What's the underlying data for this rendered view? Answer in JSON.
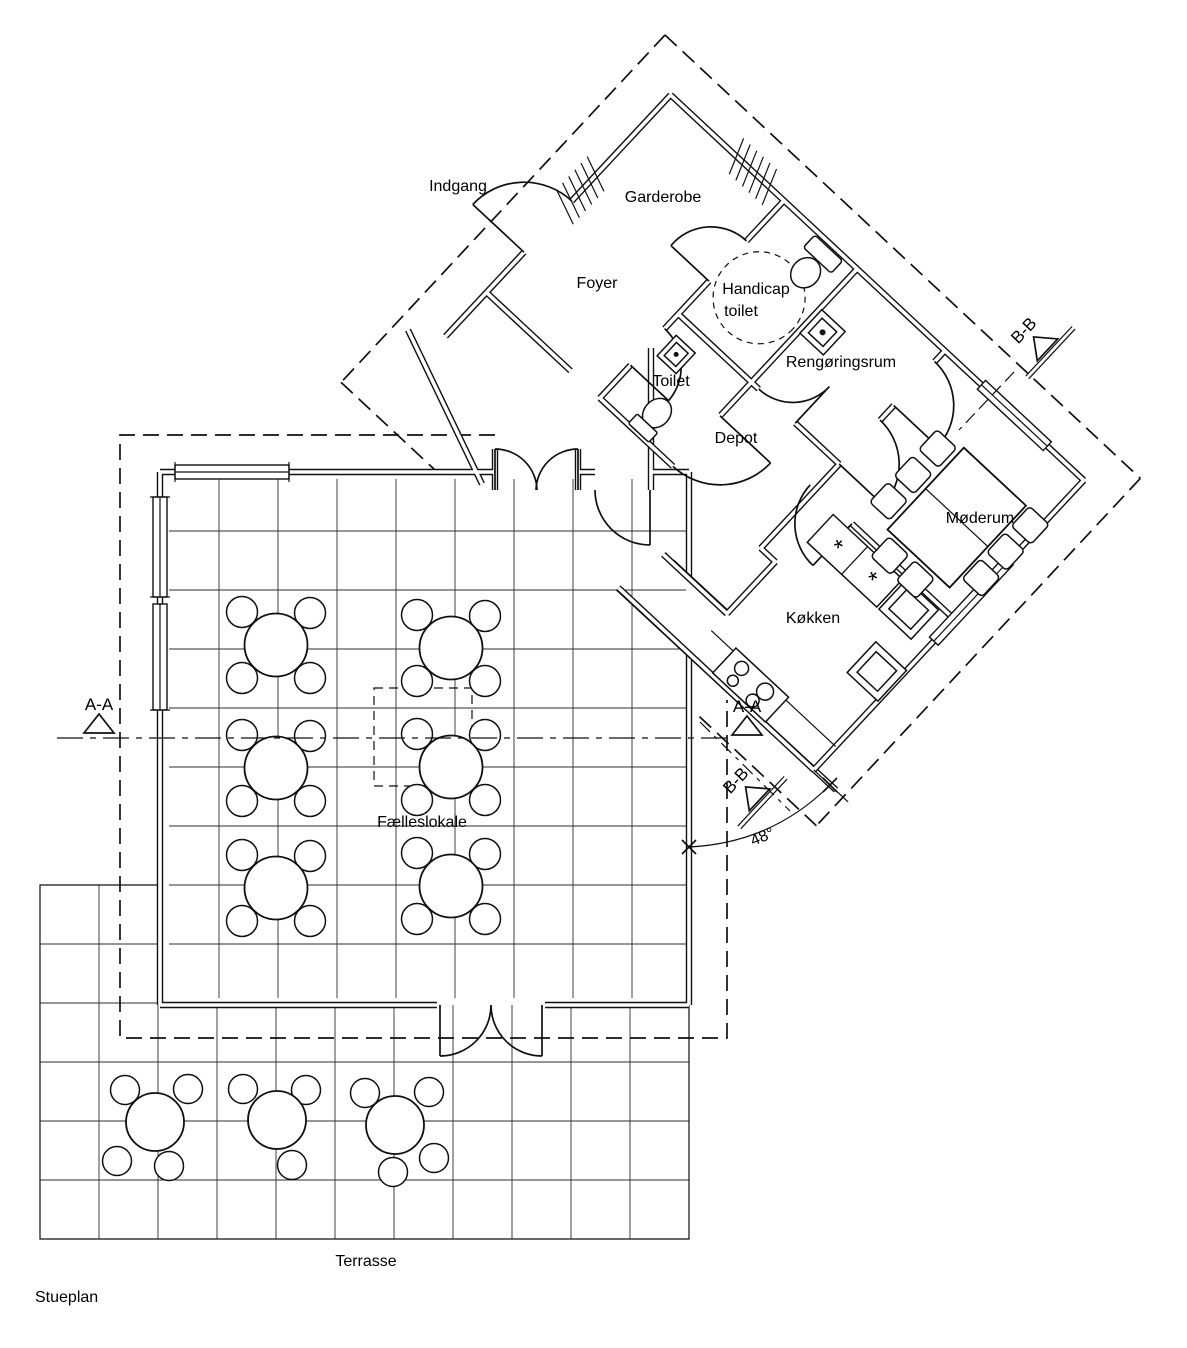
{
  "title": {
    "plan_label": "Stueplan"
  },
  "rooms": {
    "indgang": "Indgang",
    "garderobe": "Garderobe",
    "foyer": "Foyer",
    "handicap_line1": "Handicap",
    "handicap_line2": "toilet",
    "rengoringsrum": "Rengøringsrum",
    "toilet": "Toilet",
    "depot": "Depot",
    "moederum": "Møderum",
    "koekken": "Køkken",
    "faelleslokale": "Fælleslokale",
    "terrasse": "Terrasse"
  },
  "section_markers": {
    "aa": "A-A",
    "bb": "B-B",
    "angle": "48°"
  },
  "symbols": {
    "counter_mark": "*"
  },
  "colors": {
    "line": "#101010",
    "background": "#ffffff"
  }
}
